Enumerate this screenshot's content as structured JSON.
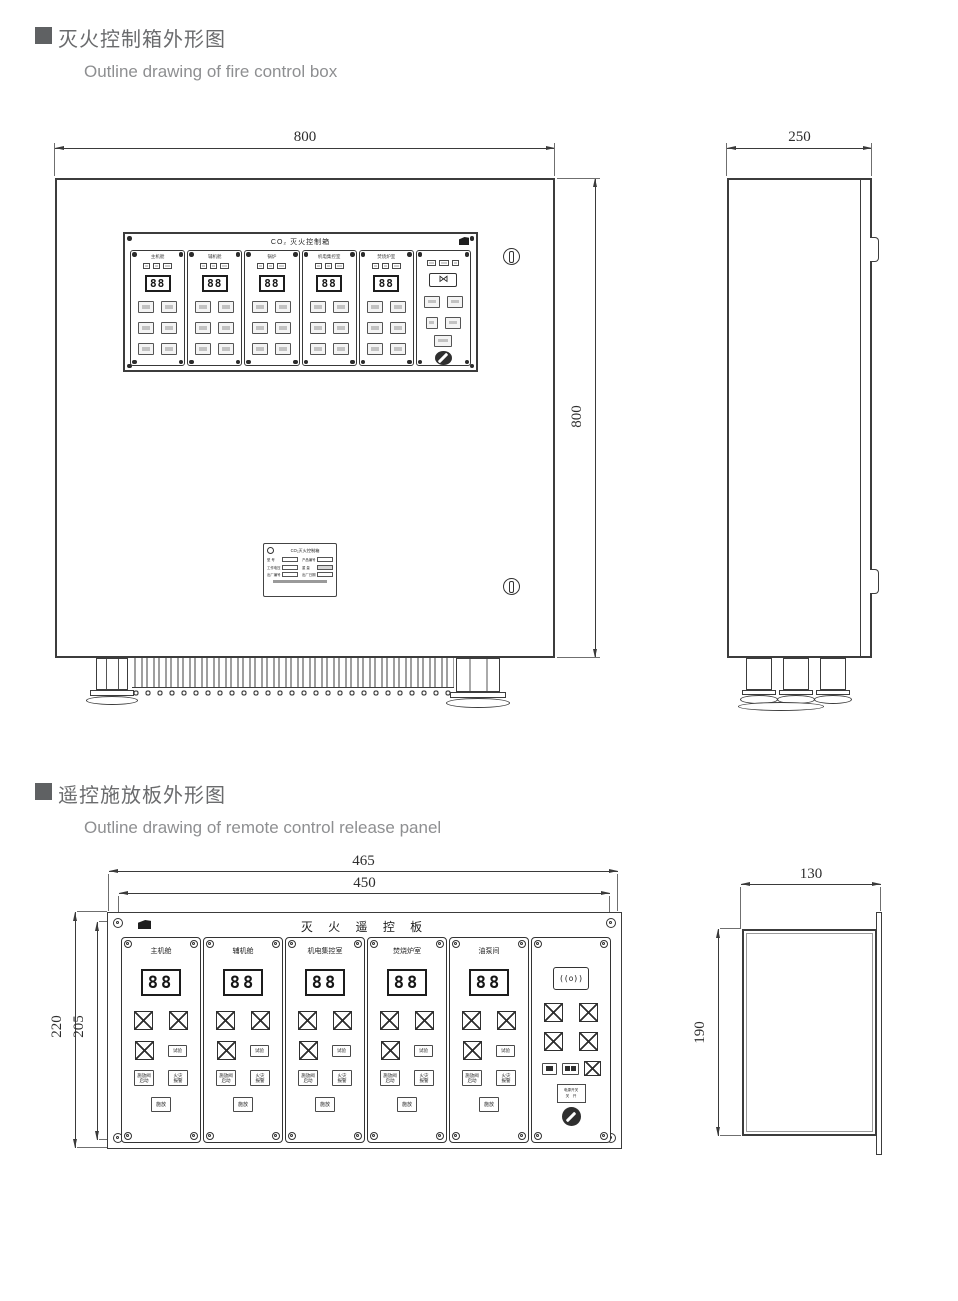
{
  "titles": {
    "s1_zh": "灭火控制箱外形图",
    "s1_en": "Outline drawing of fire control box",
    "s2_zh": "遥控施放板外形图",
    "s2_en": "Outline drawing of remote control release panel"
  },
  "icons": {
    "bowtie": "⋈",
    "speaker": "((o))"
  },
  "fire_box": {
    "dim_width": "800",
    "dim_depth": "250",
    "dim_height": "800",
    "panel": {
      "title": "CO₂ 灭火控制箱",
      "digits": "88",
      "zones": [
        {
          "label": "主机舱"
        },
        {
          "label": "辅机舱"
        },
        {
          "label": "锅炉"
        },
        {
          "label": "机电集控室"
        },
        {
          "label": "焚烧炉室"
        }
      ]
    },
    "nameplate": {
      "title": "CO₂灭火控制箱",
      "f1": "型 号",
      "f2": "工作电压",
      "f3": "出厂编号",
      "f4": "产品编号",
      "f5": "重 量",
      "f6": "出厂日期"
    }
  },
  "remote": {
    "dim_outer_w": "465",
    "dim_inner_w": "450",
    "dim_outer_h": "220",
    "dim_inner_h": "205",
    "dim_side_w": "130",
    "dim_side_h": "190",
    "title": "灭 火 遥 控 板",
    "digits": "88",
    "zones": [
      {
        "label": "主机舱"
      },
      {
        "label": "辅机舱"
      },
      {
        "label": "机电集控室"
      },
      {
        "label": "焚烧炉室"
      },
      {
        "label": "油泵间"
      }
    ],
    "btn_test": "试验",
    "btn_release_l1": "施放阀",
    "btn_release_l2": "启动",
    "btn_alarm_l1": "火灾",
    "btn_alarm_l2": "报警",
    "btn_bottom": "施放",
    "power_l1": "电源开关",
    "power_l2": "关　开"
  }
}
